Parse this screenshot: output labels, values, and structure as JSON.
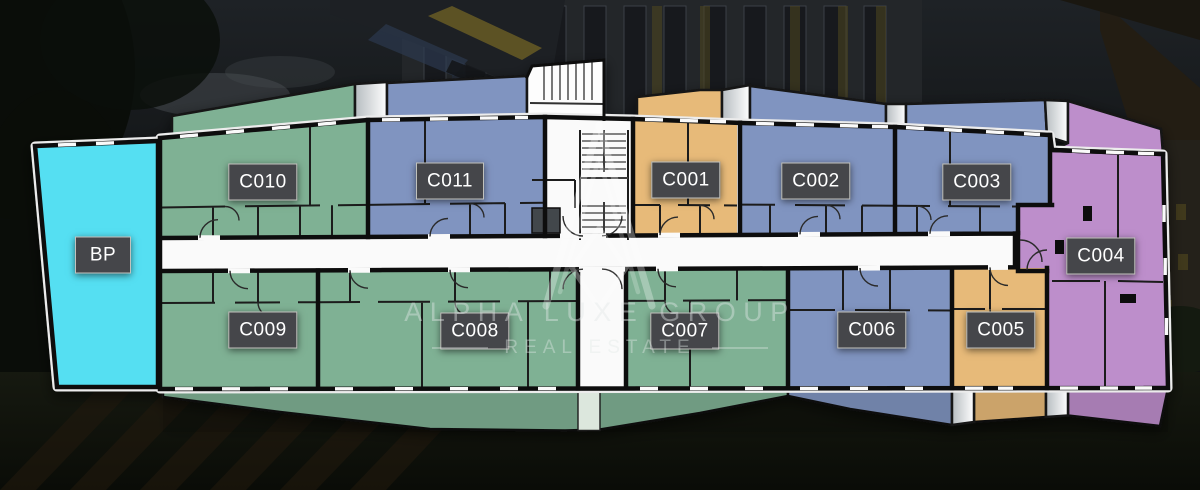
{
  "brand": {
    "name": "ALPHA LUXE GROUP",
    "tagline": "REAL ESTATE"
  },
  "palette": {
    "cyan": "#55dff2",
    "green": "#7fb194",
    "blue": "#8094c0",
    "orange": "#e7ba79",
    "purple": "#bd8ecb",
    "floor_white": "#fafafa",
    "wall": "#101010",
    "wall_thin": "#1c1c1c",
    "window_mark": "#fafafa",
    "chip_bg": "#45464a",
    "chip_text": "#ffffff",
    "outline_white": "#ececec",
    "walkway": "#dce7dd"
  },
  "units": [
    {
      "id": "bp",
      "label": "BP",
      "color_key": "cyan"
    },
    {
      "id": "c010",
      "label": "C010",
      "color_key": "green"
    },
    {
      "id": "c011",
      "label": "C011",
      "color_key": "blue"
    },
    {
      "id": "c001",
      "label": "C001",
      "color_key": "orange"
    },
    {
      "id": "c002",
      "label": "C002",
      "color_key": "blue"
    },
    {
      "id": "c003",
      "label": "C003",
      "color_key": "blue"
    },
    {
      "id": "c004",
      "label": "C004",
      "color_key": "purple"
    },
    {
      "id": "c009",
      "label": "C009",
      "color_key": "green"
    },
    {
      "id": "c008",
      "label": "C008",
      "color_key": "green"
    },
    {
      "id": "c007",
      "label": "C007",
      "color_key": "green"
    },
    {
      "id": "c006",
      "label": "C006",
      "color_key": "blue"
    },
    {
      "id": "c005",
      "label": "C005",
      "color_key": "orange"
    }
  ]
}
